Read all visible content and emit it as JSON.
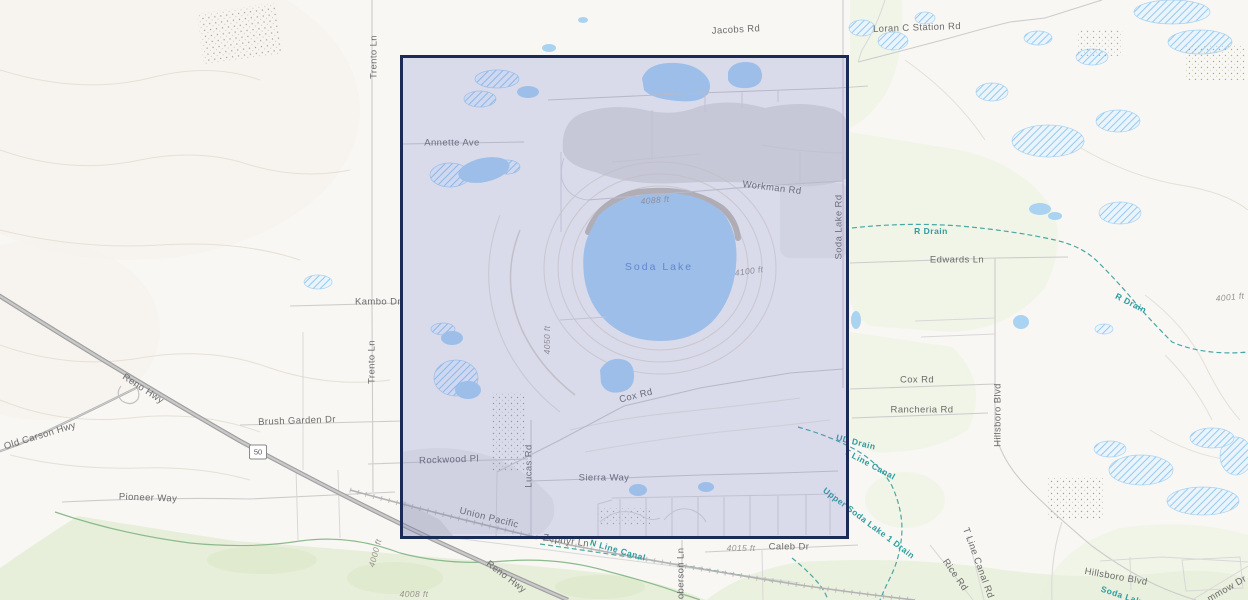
{
  "map": {
    "canvas": {
      "width": 1248,
      "height": 600
    },
    "colors": {
      "background": "#f8f7f4",
      "water": "#a9d3f1",
      "vegetation": "#e7efda",
      "contour": "#e6e0d4",
      "gray": "#dcdcd9",
      "road": "#cccccc",
      "drain": "#4aa6a6",
      "river": "#8cba8c",
      "label_road": "#6b6b6b",
      "label_water": "#2f9c9e",
      "label_lake": "#5d8ecd",
      "label_elev": "#98948c",
      "sel_border": "#1c2b55",
      "sel_fill": "rgba(110,118,200,0.22)"
    },
    "selection": {
      "x": 400,
      "y": 55,
      "width": 449,
      "height": 484
    },
    "shield": {
      "text": "50",
      "x": 258,
      "y": 452
    },
    "labels": [
      {
        "text": "Jacobs Rd",
        "x": 736,
        "y": 30,
        "r": -3,
        "type": "road"
      },
      {
        "text": "Loran C Station Rd",
        "x": 917,
        "y": 28,
        "r": -2,
        "type": "road"
      },
      {
        "text": "Trento Ln",
        "x": 374,
        "y": 57,
        "r": -90,
        "type": "road"
      },
      {
        "text": "Annette Ave",
        "x": 452,
        "y": 143,
        "r": 0,
        "type": "road"
      },
      {
        "text": "Workman Rd",
        "x": 772,
        "y": 188,
        "r": 7,
        "type": "road"
      },
      {
        "text": "Soda Lake Rd",
        "x": 839,
        "y": 227,
        "r": -90,
        "type": "road"
      },
      {
        "text": "R Drain",
        "x": 931,
        "y": 231,
        "r": 0,
        "type": "water"
      },
      {
        "text": "Edwards Ln",
        "x": 957,
        "y": 260,
        "r": 0,
        "type": "road"
      },
      {
        "text": "R Drain",
        "x": 1131,
        "y": 303,
        "r": 27,
        "type": "water"
      },
      {
        "text": "4001 ft",
        "x": 1230,
        "y": 297,
        "r": -6,
        "type": "elev"
      },
      {
        "text": "Soda Lake",
        "x": 659,
        "y": 267,
        "r": 0,
        "type": "lake"
      },
      {
        "text": "4100 ft",
        "x": 749,
        "y": 271,
        "r": -8,
        "type": "elev"
      },
      {
        "text": "4088 ft",
        "x": 655,
        "y": 200,
        "r": -5,
        "type": "elev"
      },
      {
        "text": "Kambo Dr",
        "x": 378,
        "y": 302,
        "r": 0,
        "type": "road"
      },
      {
        "text": "Trento Ln",
        "x": 372,
        "y": 362,
        "r": -90,
        "type": "road"
      },
      {
        "text": "4050 ft",
        "x": 547,
        "y": 340,
        "r": -90,
        "type": "elev"
      },
      {
        "text": "Cox Rd",
        "x": 636,
        "y": 396,
        "r": -14,
        "type": "road"
      },
      {
        "text": "Cox Rd",
        "x": 917,
        "y": 380,
        "r": 0,
        "type": "road"
      },
      {
        "text": "Rancheria Rd",
        "x": 922,
        "y": 410,
        "r": 0,
        "type": "road"
      },
      {
        "text": "Hillsboro Blvd",
        "x": 998,
        "y": 415,
        "r": -90,
        "type": "road"
      },
      {
        "text": "Brush Garden Dr",
        "x": 297,
        "y": 421,
        "r": -2,
        "type": "road"
      },
      {
        "text": "Reno Hwy",
        "x": 143,
        "y": 389,
        "r": 33,
        "type": "road"
      },
      {
        "text": "Old Carson Hwy",
        "x": 40,
        "y": 436,
        "r": -17,
        "type": "road"
      },
      {
        "text": "Pioneer Way",
        "x": 148,
        "y": 498,
        "r": 2,
        "type": "road"
      },
      {
        "text": "Rockwood Pl",
        "x": 449,
        "y": 460,
        "r": -2,
        "type": "road"
      },
      {
        "text": "Lucas Rd",
        "x": 529,
        "y": 466,
        "r": -90,
        "type": "road"
      },
      {
        "text": "Sierra Way",
        "x": 604,
        "y": 478,
        "r": 0,
        "type": "road"
      },
      {
        "text": "Union Pacific",
        "x": 489,
        "y": 518,
        "r": 14,
        "type": "road"
      },
      {
        "text": "Zephyr Ln",
        "x": 566,
        "y": 541,
        "r": 8,
        "type": "road"
      },
      {
        "text": "N Line Canal",
        "x": 618,
        "y": 550,
        "r": 16,
        "type": "water"
      },
      {
        "text": "Roberson Ln",
        "x": 681,
        "y": 577,
        "r": -90,
        "type": "road"
      },
      {
        "text": "Caleb Dr",
        "x": 789,
        "y": 547,
        "r": 0,
        "type": "road"
      },
      {
        "text": "4015 ft",
        "x": 741,
        "y": 548,
        "r": 0,
        "type": "elev"
      },
      {
        "text": "Reno Hwy",
        "x": 506,
        "y": 577,
        "r": 37,
        "type": "road"
      },
      {
        "text": "UD Drain",
        "x": 856,
        "y": 442,
        "r": 14,
        "type": "water"
      },
      {
        "text": "T Line Canal",
        "x": 870,
        "y": 464,
        "r": 28,
        "type": "water"
      },
      {
        "text": "Upper Soda Lake 1 Drain",
        "x": 869,
        "y": 523,
        "r": 37,
        "type": "water"
      },
      {
        "text": "Rice Rd",
        "x": 955,
        "y": 575,
        "r": 55,
        "type": "road"
      },
      {
        "text": "T Line Canal Rd",
        "x": 978,
        "y": 563,
        "r": 70,
        "type": "road"
      },
      {
        "text": "Hillsboro Blvd",
        "x": 1116,
        "y": 577,
        "r": 10,
        "type": "road"
      },
      {
        "text": "mmow Dr",
        "x": 1227,
        "y": 589,
        "r": -30,
        "type": "road"
      },
      {
        "text": "Soda Lak",
        "x": 1121,
        "y": 595,
        "r": 18,
        "type": "water"
      },
      {
        "text": "4000 ft",
        "x": 375,
        "y": 553,
        "r": -75,
        "type": "elev"
      },
      {
        "text": "4008 ft",
        "x": 414,
        "y": 594,
        "r": 0,
        "type": "elev"
      }
    ]
  }
}
